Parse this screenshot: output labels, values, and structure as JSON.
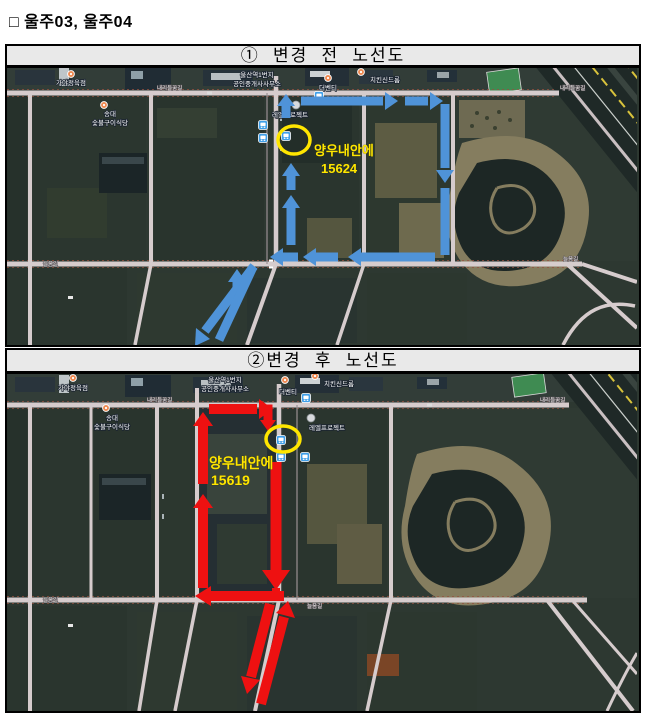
{
  "title": "□ 울주03, 울주04",
  "colors": {
    "route_before": "#4f93d8",
    "route_after": "#ee1111",
    "highlight_yellow": "#ffe600",
    "header_bg": "#e9e9e9"
  },
  "panels": [
    {
      "header": "① 변경 전 노선도",
      "annotation": {
        "stop_name": "양우내안에",
        "stop_number": "15624"
      },
      "labels": {
        "butcher_shop": "가야정육점",
        "office_line1": "울산역1번지",
        "office_line2": "공인중개사사무소",
        "cafe": "더벤티",
        "chicken_shop": "치킨신드롬",
        "restaurant_line1": "송대",
        "restaurant_line2": "숯불구이식당",
        "project": "레엘프로젝트",
        "road_top": "내리들꿈길",
        "road_bottom": "늘음길"
      }
    },
    {
      "header": "②변경 후 노선도",
      "annotation": {
        "stop_name": "양우내안에",
        "stop_number": "15619"
      },
      "labels": {
        "butcher_shop": "가야정육점",
        "office_line1": "울산역1번지",
        "office_line2": "공인중개사사무소",
        "cafe": "더벤티",
        "chicken_shop": "치킨신드롬",
        "restaurant_line1": "송대",
        "restaurant_line2": "숯불구이식당",
        "project": "레엘프로젝트",
        "road_top": "내리들꿈길",
        "road_bottom": "늘음길"
      }
    }
  ]
}
